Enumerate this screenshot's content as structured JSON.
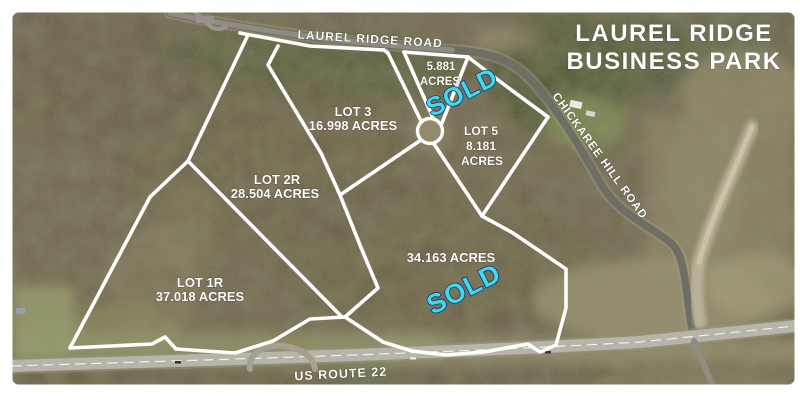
{
  "title": {
    "line1": "LAUREL RIDGE",
    "line2": "BUSINESS PARK"
  },
  "roads": {
    "laurel_ridge": "LAUREL RIDGE ROAD",
    "chickaree": "CHICKAREE HILL ROAD",
    "us_route_22": "US ROUTE 22"
  },
  "lots": {
    "lot_3": {
      "name": "LOT 3",
      "acreage": "16.998 ACRES"
    },
    "lot_2r": {
      "name": "LOT 2R",
      "acreage": "28.504 ACRES"
    },
    "lot_1r": {
      "name": "LOT 1R",
      "acreage": "37.018 ACRES"
    },
    "lot_5": {
      "name": "LOT 5",
      "acreage": "8.181",
      "acres_word": "ACRES"
    },
    "lot_small": {
      "acreage": "5.881",
      "acres_word": "ACRES"
    },
    "lot_34": {
      "acreage": "34.163 ACRES"
    }
  },
  "status": {
    "sold_upper": "SOLD",
    "sold_lower": "SOLD"
  },
  "colors": {
    "boundary": "#ffffff",
    "sold_text": "#3fdbe6",
    "label_text": "#ffffff"
  }
}
